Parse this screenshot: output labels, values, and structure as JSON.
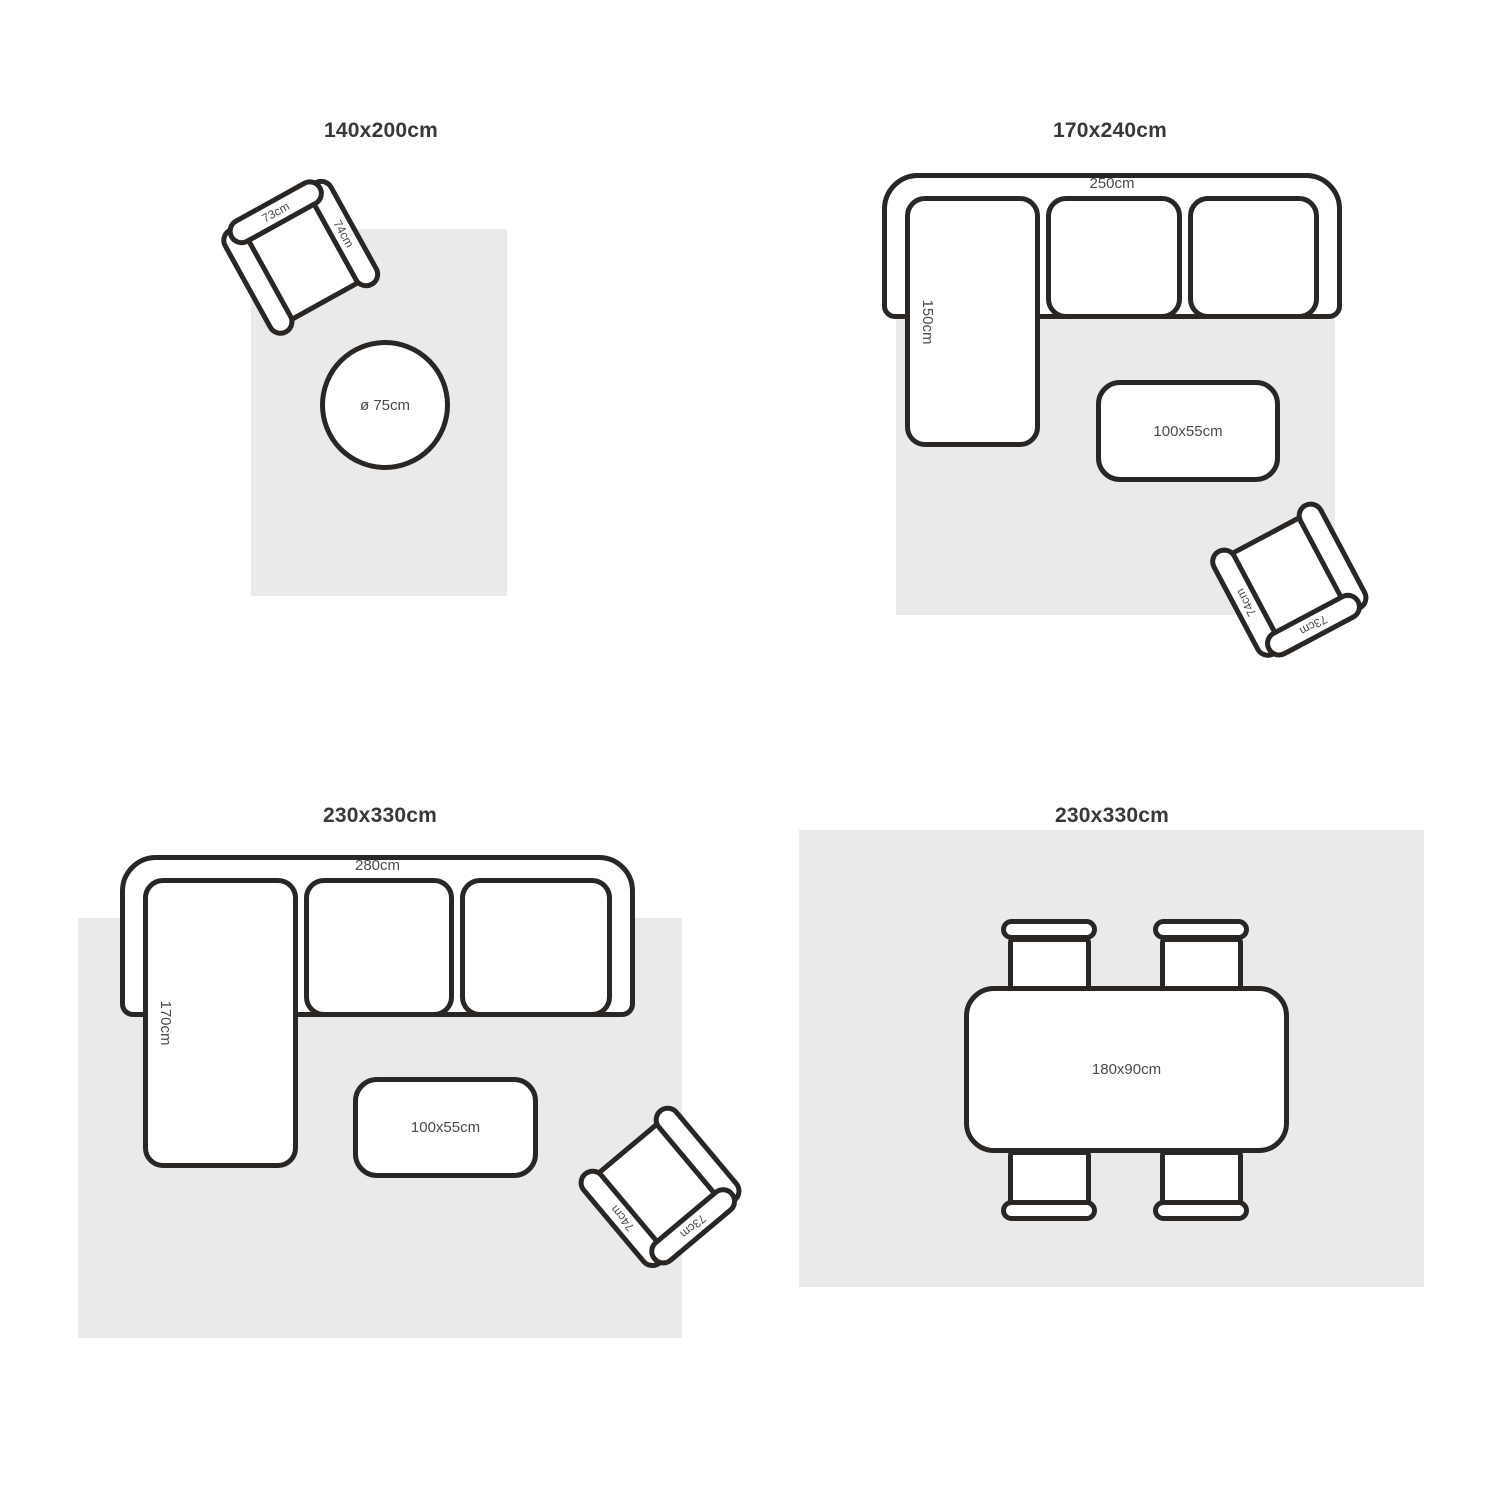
{
  "style": {
    "line_color": "#2a2623",
    "rug_color": "#eaeaea",
    "title_color": "#383838",
    "label_color": "#4a4a4a"
  },
  "sections": {
    "rug_140x200": {
      "title": "140x200cm",
      "armchair": {
        "back_width": "73cm",
        "arm_depth": "74cm"
      },
      "round_table_diameter": "ø 75cm"
    },
    "rug_170x240": {
      "title": "170x240cm",
      "sofa": {
        "width": "250cm",
        "chaise_depth": "150cm"
      },
      "coffee_table_size": "100x55cm",
      "armchair": {
        "back_width": "73cm",
        "arm_depth": "74cm"
      }
    },
    "rug_230x330_sofa": {
      "title": "230x330cm",
      "sofa": {
        "width": "280cm",
        "chaise_depth": "170cm"
      },
      "coffee_table_size": "100x55cm",
      "armchair": {
        "back_width": "73cm",
        "arm_depth": "74cm"
      }
    },
    "rug_230x330_dining": {
      "title": "230x330cm",
      "dining_table_size": "180x90cm"
    }
  }
}
